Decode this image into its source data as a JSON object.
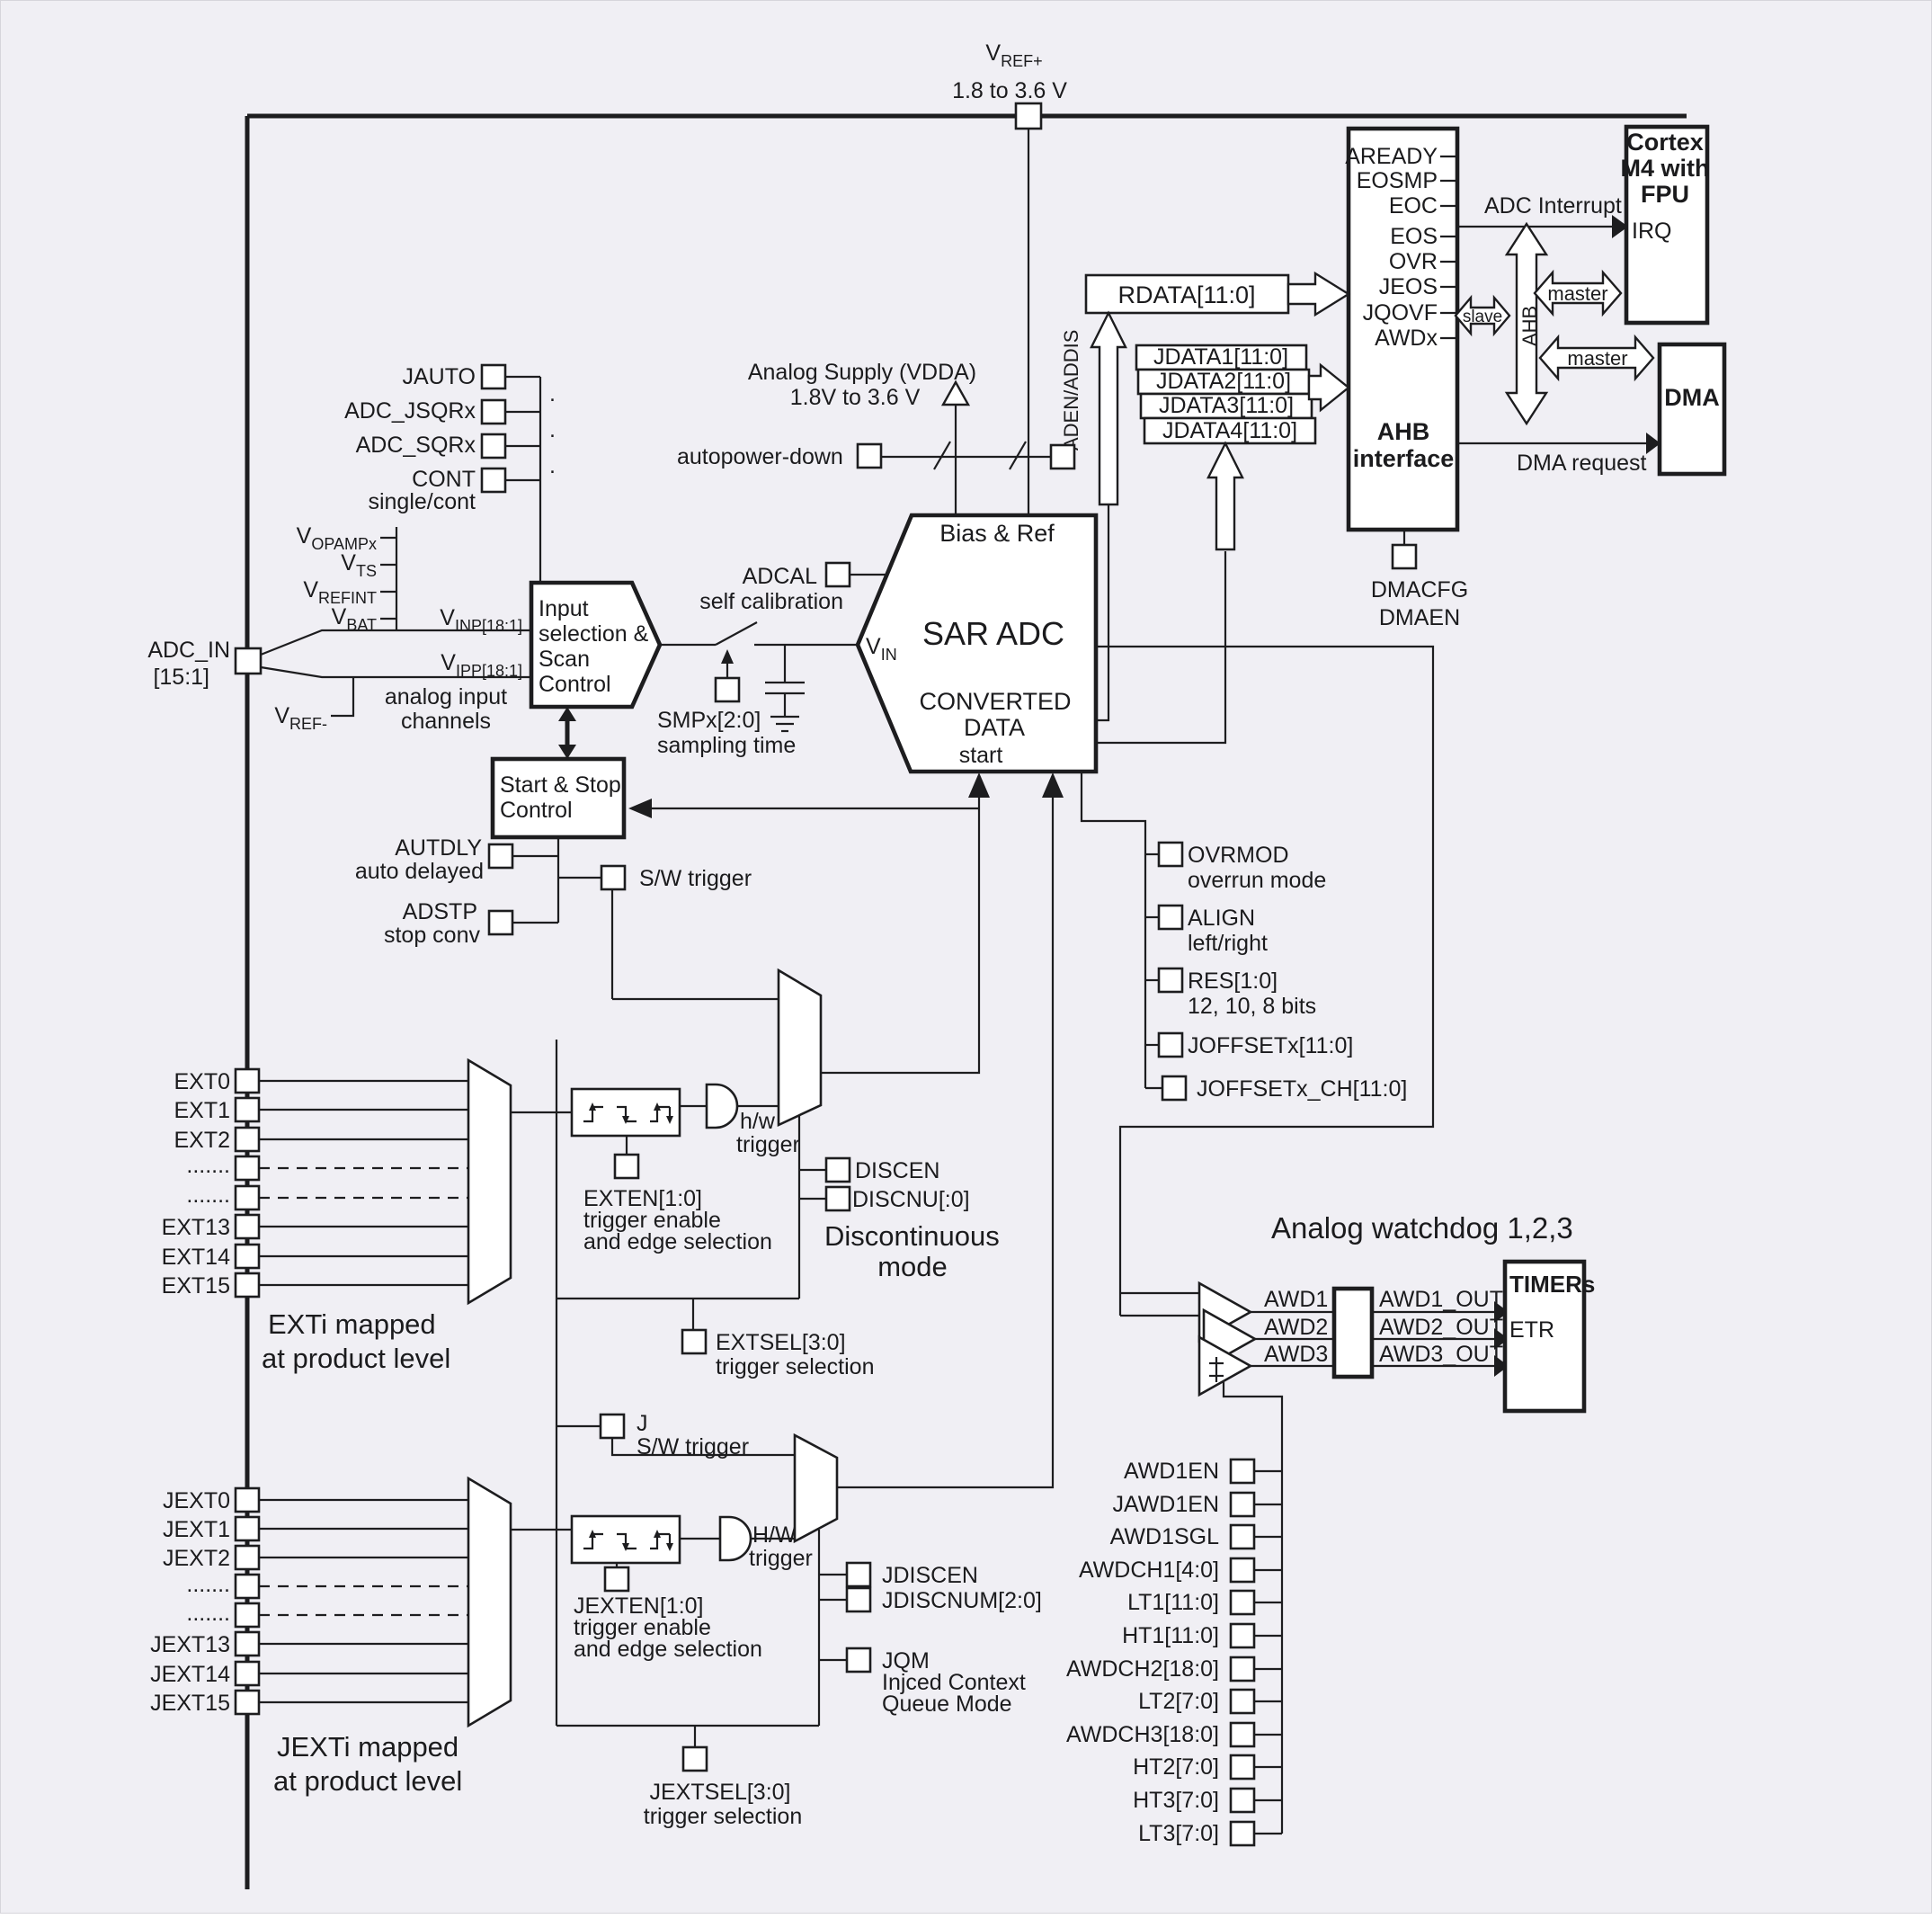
{
  "colors": {
    "background": "#f0eff4",
    "line": "#1d1d1f",
    "fill": "#ffffff"
  },
  "top": {
    "vref": "V",
    "vref_sub": "REF+",
    "vref_range": "1.8 to 3.6 V"
  },
  "cortex": {
    "l1": "Cortex",
    "l2": "M4 with",
    "l3": "FPU",
    "irq": "IRQ"
  },
  "ahb": {
    "signals": [
      "AREADY",
      "EOSMP",
      "EOC",
      "EOS",
      "OVR",
      "JEOS",
      "JQOVF",
      "AWDx"
    ],
    "l1": "AHB",
    "l2": "interface",
    "adc_interrupt": "ADC Interrupt",
    "slave": "slave",
    "master1": "master",
    "master2": "master",
    "bus": "AHB"
  },
  "dma": {
    "name": "DMA",
    "request": "DMA request",
    "cfg": "DMACFG",
    "en": "DMAEN"
  },
  "regs": {
    "rdata": "RDATA[11:0]",
    "jdata1": "JDATA1[11:0]",
    "jdata2": "JDATA2[11:0]",
    "jdata3": "JDATA3[11:0]",
    "jdata4": "JDATA4[11:0]",
    "aden": "ADEN/ADDIS"
  },
  "supply": {
    "l1": "Analog Supply (VDDA)",
    "l2": "1.8V to 3.6 V",
    "autopower": "autopower-down"
  },
  "ctrl_regs": {
    "jauto": "JAUTO",
    "jsqr": "ADC_JSQRx",
    "sqr": "ADC_SQRx",
    "cont": "CONT",
    "cont2": "single/cont",
    "dot": "."
  },
  "inputs": {
    "vopamp": "V",
    "vopamp_sub": "OPAMPx",
    "vts": "V",
    "vts_sub": "TS",
    "vrefint": "V",
    "vrefint_sub": "REFINT",
    "vbat": "V",
    "vbat_sub": "BAT",
    "adcin1": "ADC_IN",
    "adcin2": "[15:1]",
    "vrefm": "V",
    "vrefm_sub": "REF-",
    "vinp": "V",
    "vinp_sub": "INP[18:1]",
    "vipp": "V",
    "vipp_sub": "IPP[18:1]",
    "ch1": "analog input",
    "ch2": "channels"
  },
  "inputsel": {
    "l1": "Input",
    "l2": "selection &",
    "l3": "Scan",
    "l4": "Control"
  },
  "sampling": {
    "smp": "SMPx[2:0]",
    "time": "sampling time",
    "adcal": "ADCAL",
    "selfcal": "self calibration"
  },
  "sar": {
    "bias": "Bias & Ref",
    "title": "SAR ADC",
    "c1": "CONVERTED",
    "c2": "DATA",
    "c3": "start",
    "vin": "V",
    "vin_sub": "IN"
  },
  "startstop": {
    "l1": "Start & Stop",
    "l2": "Control",
    "autdly": "AUTDLY",
    "autdly2": "auto delayed",
    "adstp": "ADSTP",
    "adstp2": "stop conv",
    "sw": "S/W trigger"
  },
  "config": {
    "ovrmod": "OVRMOD",
    "ovrmod2": "overrun mode",
    "align": "ALIGN",
    "align2": "left/right",
    "res": "RES[1:0]",
    "res2": "12, 10, 8 bits",
    "joffset": "JOFFSETx[11:0]",
    "joffsetch": "JOFFSETx_CH[11:0]"
  },
  "regular": {
    "rows": [
      "EXT0",
      "EXT1",
      "EXT2",
      ".......",
      ".......",
      "EXT13",
      "EXT14",
      "EXT15"
    ],
    "exten": "EXTEN[1:0]",
    "exten2": "trigger enable",
    "exten3": "and edge selection",
    "hw1": "h/w",
    "hw2": "trigger",
    "discen": "DISCEN",
    "discnu": "DISCNU[:0]",
    "disc1": "Discontinuous",
    "disc2": "mode",
    "extsel": "EXTSEL[3:0]",
    "extsel2": "trigger selection",
    "mapped1": "EXTi mapped",
    "mapped2": "at product level"
  },
  "injected": {
    "rows": [
      "JEXT0",
      "JEXT1",
      "JEXT2",
      ".......",
      ".......",
      "JEXT13",
      "JEXT14",
      "JEXT15"
    ],
    "j": "J",
    "sw": "S/W trigger",
    "exten": "JEXTEN[1:0]",
    "exten2": "trigger enable",
    "exten3": "and edge selection",
    "hw1": "H/W",
    "hw2": "trigger",
    "discen": "JDISCEN",
    "discnum": "JDISCNUM[2:0]",
    "jqm": "JQM",
    "jqm2": "Injced Context",
    "jqm3": "Queue Mode",
    "extsel": "JEXTSEL[3:0]",
    "extsel2": "trigger selection",
    "mapped1": "JEXTi mapped",
    "mapped2": "at product level"
  },
  "watchdog": {
    "title": "Analog watchdog 1,2,3",
    "awd1": "AWD1",
    "awd2": "AWD2",
    "awd3": "AWD3",
    "out1": "AWD1_OUT",
    "out2": "AWD2_OUT",
    "out3": "AWD3_OUT",
    "timers": "TIMERs",
    "etr": "ETR",
    "cfg": [
      "AWD1EN",
      "JAWD1EN",
      "AWD1SGL",
      "AWDCH1[4:0]",
      "LT1[11:0]",
      "HT1[11:0]",
      "AWDCH2[18:0]",
      "LT2[7:0]",
      "AWDCH3[18:0]",
      "HT2[7:0]",
      "HT3[7:0]",
      "LT3[7:0]"
    ]
  }
}
